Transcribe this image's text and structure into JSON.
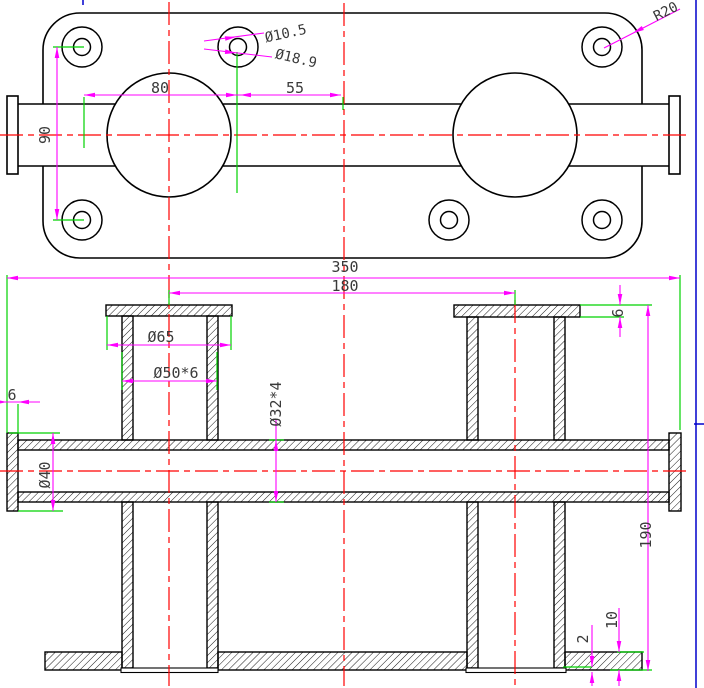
{
  "colors": {
    "outline": "#000000",
    "dimension": "#ff00ff",
    "extension": "#00d200",
    "centerline": "#ff0000",
    "viewport_border": "#0000cc",
    "label_text": "#3a3a3a",
    "background": "#ffffff"
  },
  "top_view": {
    "dim_80": "80",
    "dim_55": "55",
    "dim_90": "90",
    "hole_diameter": "Ø10.5",
    "boss_diameter": "Ø18.9",
    "corner_radius": "R20"
  },
  "section_view": {
    "dim_350": "350",
    "dim_180": "180",
    "socket_flange_diameter": "Ø65",
    "socket_tube_spec": "Ø50*6",
    "main_pipe_spec": "Ø32*4",
    "pipe_flange_diameter": "Ø40",
    "pipe_flange_thickness": "6",
    "socket_flange_thickness": "6",
    "dim_190": "190",
    "base_plate_thickness": "10",
    "tube_protrusion": "2"
  }
}
